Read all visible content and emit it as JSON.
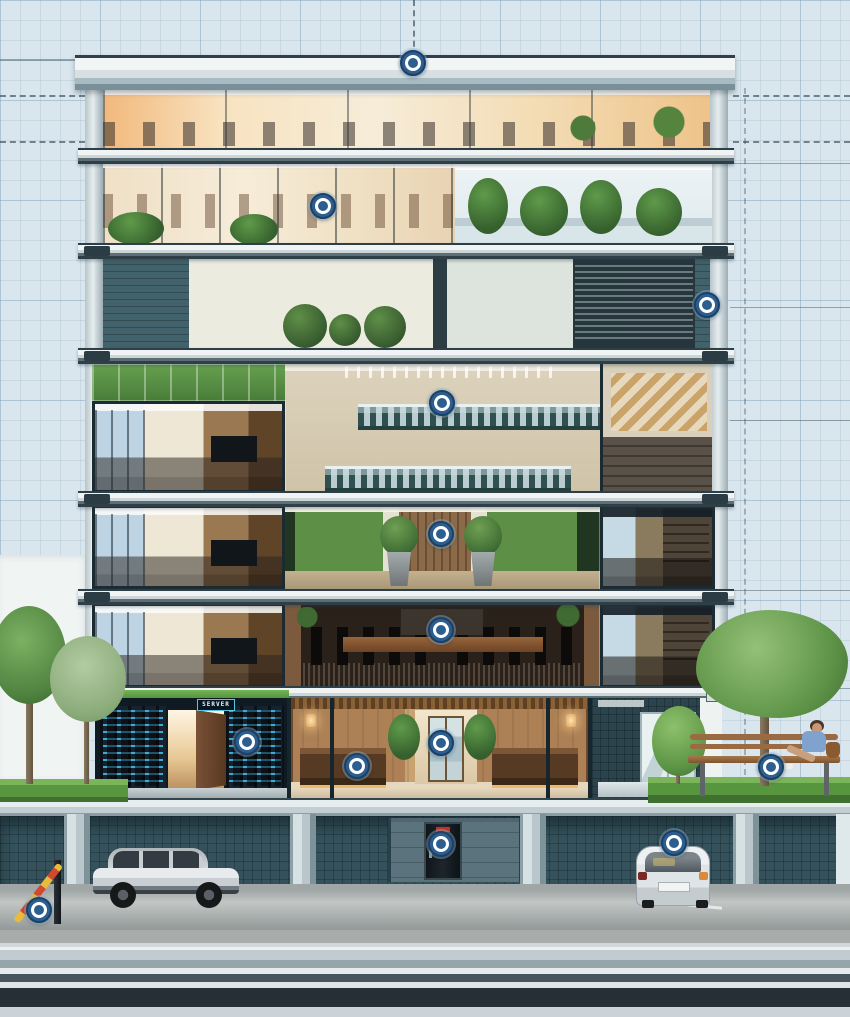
{
  "scene": {
    "description": "Cutaway cross-section of a modern office building on a blueprint backdrop with clickable hotspots",
    "colors": {
      "blueprint_background": "#d9e6ee",
      "hotspot_fill": "#2d5e90",
      "hotspot_ring": "#ffffff",
      "structure_dark": "#2e3f47",
      "server_led": "#55c8e8",
      "grass": "#5d9b47"
    }
  },
  "signs": {
    "server_room": "SERVER"
  },
  "hotspots": [
    {
      "id": "roof",
      "area": "roof parapet",
      "x": 413,
      "y": 63
    },
    {
      "id": "staff-office",
      "area": "open-plan office",
      "x": 323,
      "y": 206
    },
    {
      "id": "right-facade",
      "area": "east facade column",
      "x": 707,
      "y": 305
    },
    {
      "id": "staircase",
      "area": "atrium staircase",
      "x": 442,
      "y": 403
    },
    {
      "id": "green-lounge",
      "area": "biophilic lounge",
      "x": 441,
      "y": 534
    },
    {
      "id": "meeting-room",
      "area": "boardroom",
      "x": 441,
      "y": 630
    },
    {
      "id": "server-room",
      "area": "server room",
      "x": 247,
      "y": 742
    },
    {
      "id": "lobby-door",
      "area": "lobby inner door",
      "x": 441,
      "y": 743
    },
    {
      "id": "reception",
      "area": "reception desk",
      "x": 357,
      "y": 766
    },
    {
      "id": "bench",
      "area": "street bench",
      "x": 771,
      "y": 767
    },
    {
      "id": "service-door",
      "area": "garage service door",
      "x": 441,
      "y": 844
    },
    {
      "id": "parked-car",
      "area": "parking space",
      "x": 674,
      "y": 843
    },
    {
      "id": "barrier",
      "area": "parking barrier",
      "x": 39,
      "y": 910
    }
  ]
}
